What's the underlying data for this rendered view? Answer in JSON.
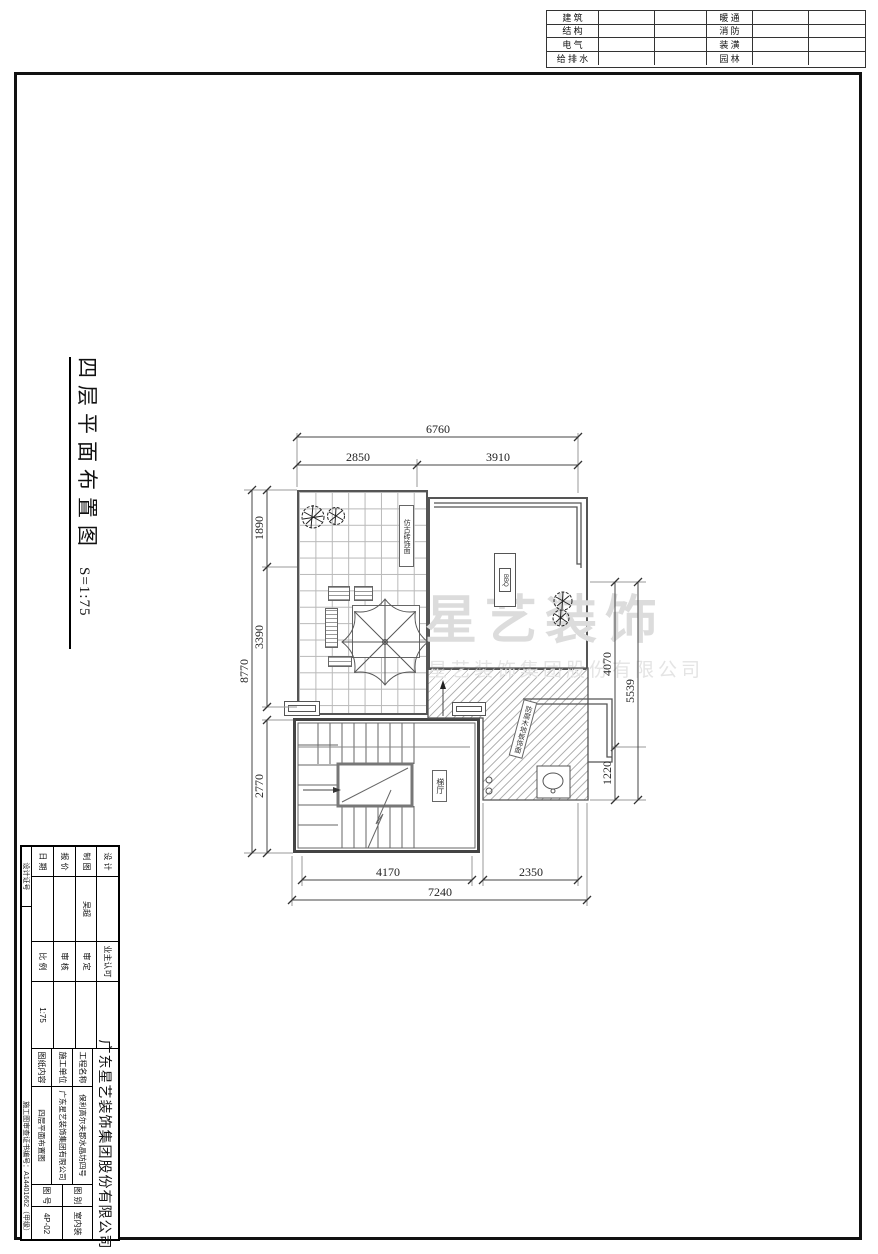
{
  "disciplines": {
    "left": [
      "建  筑",
      "结  构",
      "电  气",
      "给 排 水"
    ],
    "right": [
      "暖  通",
      "消  防",
      "装  潢",
      "园  林"
    ]
  },
  "title": {
    "text": "四层平面布置图",
    "scale": "S=1:75"
  },
  "watermark": {
    "line1": "星艺装饰",
    "line2": "星艺装饰集团股份有限公司"
  },
  "plan": {
    "dims": {
      "top_overall": "6760",
      "top_seg1": "2850",
      "top_seg2": "3910",
      "left_overall": "8770",
      "left_seg1": "1890",
      "left_seg2": "3390",
      "left_seg3": "2770",
      "right_overall": "5539",
      "right_seg1": "4070",
      "right_seg2": "1220",
      "bottom_overall": "7240",
      "bottom_seg1": "4170",
      "bottom_seg2": "2350"
    },
    "labels": {
      "terrace_finish": "仿古砖饰面",
      "bbq": "BBQ",
      "deck_finish": "防腐木地板饰面",
      "stair_hall": "梯厅"
    }
  },
  "title_block": {
    "company": "广东星艺装饰集团股份有限公司",
    "rows": [
      {
        "l1": "设 计",
        "v1": "",
        "l2": "业主认可",
        "v2": ""
      },
      {
        "l1": "制 图",
        "v1": "吴超",
        "l2": "审 定",
        "v2": ""
      },
      {
        "l1": "报 价",
        "v1": "",
        "l2": "审 核",
        "v2": ""
      },
      {
        "l1": "日 期",
        "v1": "",
        "l2": "比 例",
        "v2": "1:75"
      }
    ],
    "project_label": "工程名称",
    "project_value": "保利高尔夫郡水晶坊四号",
    "builder_label": "施工单位",
    "builder_value": "广东星艺装饰集团有限公司",
    "content_label": "图纸内容",
    "content_value": "四层平面布置图",
    "type_label": "图 别",
    "type_value": "室内装",
    "no_label": "图 号",
    "no_value": "4P-02",
    "cert_label": "设计证号",
    "review_no": "施工图审查证书编号：A14401662（甲级）"
  }
}
